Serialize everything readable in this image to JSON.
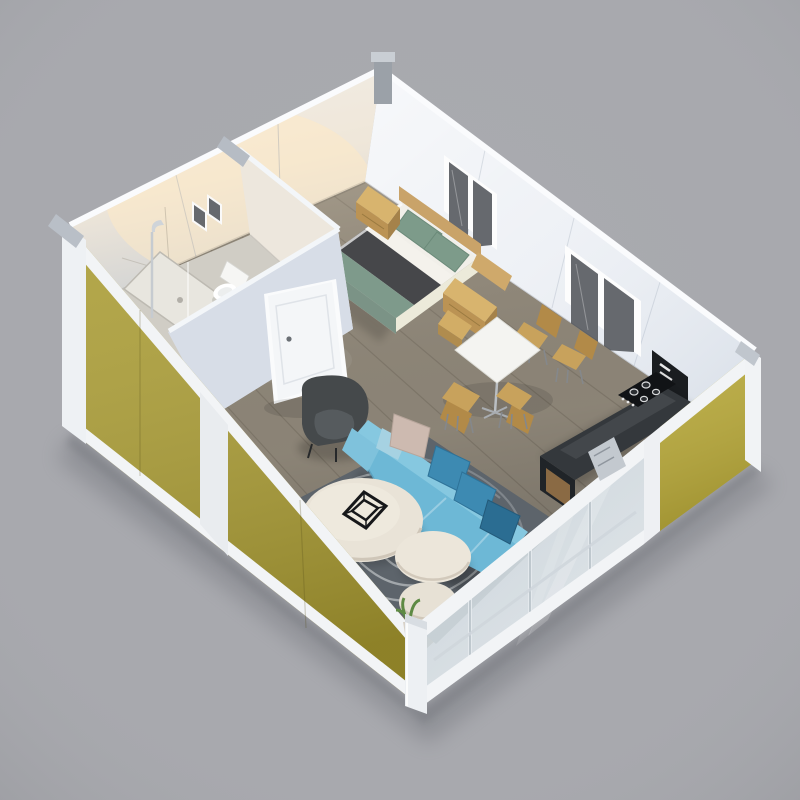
{
  "scene": {
    "description": "3D isometric cutaway render of an expandable container tiny-house: open-top white box with olive-yellow exterior panels, bathroom, bedroom, dining area, kitchenette and living room with blue sectional sofa",
    "background": "#a8a9ae",
    "colors": {
      "bg": "#a8a9ae",
      "exterior_yellow": "#a99b31",
      "exterior_yellow2": "#b7a839",
      "rail_white": "#f2f4f6",
      "post_white": "#eef1f4",
      "metal_fitting": "#9ba1a8",
      "metal_fitting_light": "#c9ced4",
      "wall_warm": "#eae6df",
      "wall_cool": "#edf0f5",
      "partition_face": "#e3e6ec",
      "partition_face2": "#d7dde7",
      "door_white": "#f4f6f8",
      "window_pane": "#66696e",
      "floor_wood": "#91897b",
      "bathroom_floor": "#d0cdc5",
      "shower_tray": "#e8e6df",
      "toilet_white": "#f6f6f4",
      "chrome": "#c6cbd0",
      "headboard_wood": "#c9a369",
      "nightstand_wood": "#d8b46e",
      "nightstand_wood_dark": "#bb9354",
      "nightstand_wood_side": "#a5824a",
      "pillow_green": "#7d9b8a",
      "sheet_white": "#f1efe9",
      "blanket_charcoal": "#46474a",
      "duvet_green": "#7e9a8b",
      "duvet_green_dark": "#6f8a7c",
      "bed_base": "#e9e7dc",
      "table_white": "#f4f4f1",
      "chair_wood": "#c8a25c",
      "chair_wood_dark": "#b28a48",
      "chair_leg": "#85888b",
      "counter_top": "#34383c",
      "counter_front": "#202428",
      "cabinet_wood": "#8a6a44",
      "cooktop_black": "#111316",
      "appliance_black": "#1a1d20",
      "sofa_body": "#6db8d6",
      "sofa_back": "#86c8e0",
      "sofa_arm": "#7fc2dc",
      "pillow_teal": "#3d8ab2",
      "pillow_teal_dark": "#2b6d92",
      "pillow_blush": "#cdbab0",
      "pillow_sky": "#a6d2e2",
      "armchair_body": "#45494b",
      "armchair_seat": "#565b5e",
      "coffee_table": "#e9e3d7",
      "coffee_table2": "#ece6da",
      "rug_base": "#646b72",
      "rug_stripe": "#c9cdd0",
      "decor_black": "#17181a",
      "plant_green": "#5e8a44",
      "pot_tan": "#d8d2c8"
    },
    "rooms": [
      {
        "id": "bathroom",
        "label": "Bathroom",
        "items": [
          "shower",
          "toilet",
          "white door",
          "two small vent windows"
        ]
      },
      {
        "id": "bedroom",
        "label": "Bedroom",
        "items": [
          "double bed",
          "green pillows",
          "charcoal blanket",
          "sage duvet",
          "wood headboard",
          "two nightstands"
        ]
      },
      {
        "id": "dining",
        "label": "Dining area",
        "items": [
          "white square table",
          "four wooden chairs"
        ]
      },
      {
        "id": "kitchen",
        "label": "Kitchenette",
        "items": [
          "dark counter",
          "gas cooktop",
          "appliance column",
          "wood cabinet"
        ]
      },
      {
        "id": "living",
        "label": "Living room",
        "items": [
          "blue sectional sofa",
          "teal and blush throw pillows",
          "charcoal armchair",
          "three round coffee tables",
          "swirl-pattern rug",
          "wire cube decor",
          "sliding glass door wall"
        ]
      }
    ]
  }
}
